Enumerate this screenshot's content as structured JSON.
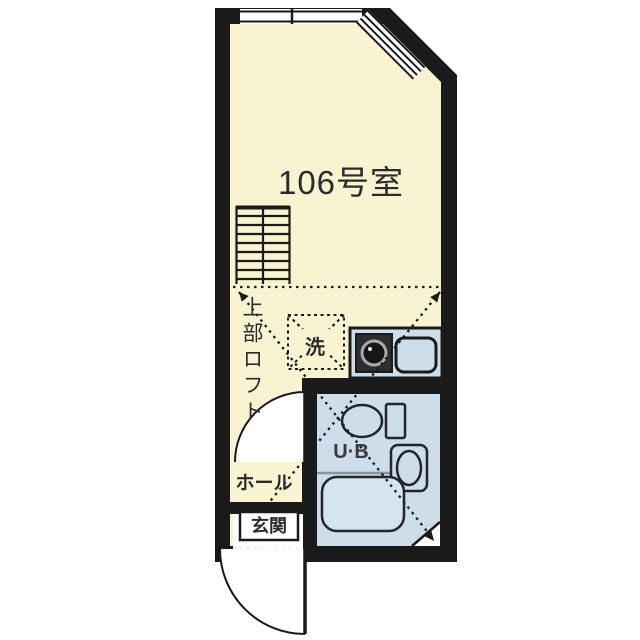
{
  "title": "Floor plan",
  "floorplan": {
    "room_label": "106号室",
    "loft_label": "上部ロフト",
    "washer_label": "洗",
    "unit_bath_label": "U·B",
    "hall_label": "ホール",
    "entrance_label": "玄関"
  },
  "icons": [
    "loft-ladder-icon",
    "stove-burner-icon",
    "kitchen-sink-icon",
    "toilet-icon",
    "washbasin-icon",
    "bathtub-icon",
    "washer-place-icon",
    "door-swing-icon",
    "window-icon"
  ],
  "colors": {
    "wall": "#1a1a1a",
    "floor": "#f8f3d0",
    "wet": "#cdddea",
    "text": "#2b2b2b",
    "paper": "#ffffff"
  }
}
